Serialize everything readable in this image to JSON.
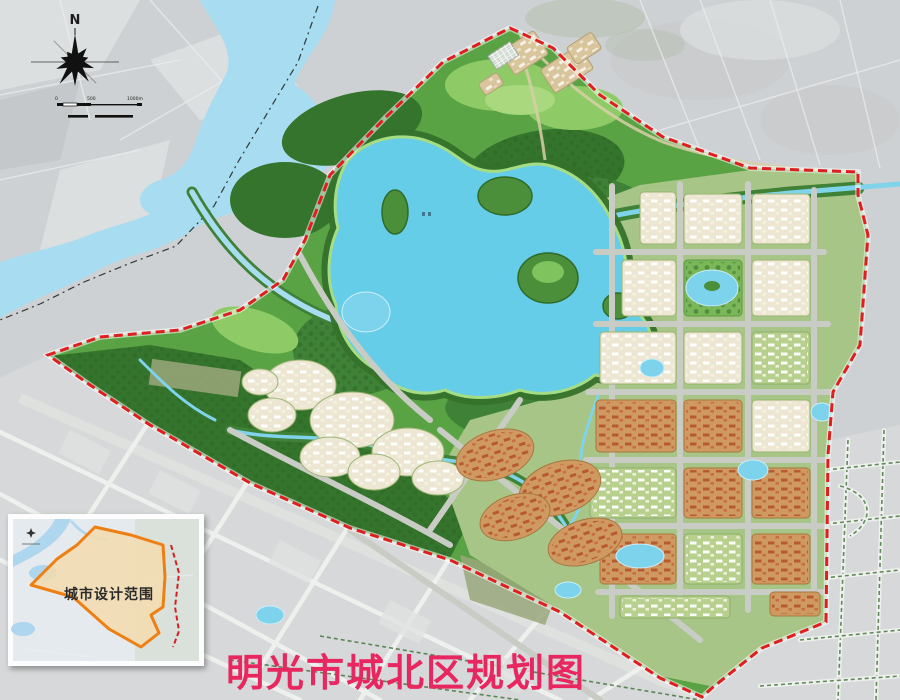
{
  "title": {
    "text": "明光市城北区规划图"
  },
  "inset": {
    "label": "城市设计范围"
  },
  "compass": {
    "label": "N"
  },
  "scale_bar": {
    "labels": [
      "0",
      "500",
      "1000m"
    ]
  },
  "colors": {
    "background_gray": "#ced1d3",
    "band_gray": "#d6d8d9",
    "water_light": "#a8dcf0",
    "lake_cyan": "#66cde9",
    "park_green": "#5aa344",
    "park_dark": "#35742c",
    "park_light": "#8ecb67",
    "urban_cream": "#ece6d2",
    "roof_orange": "#cf9a62",
    "road_gray": "#c9ccc4",
    "boundary_red": "#df1f1f",
    "inset_orange": "#ee7f12",
    "title_pink": "#e8265f",
    "ink": "#1c1c1c"
  }
}
